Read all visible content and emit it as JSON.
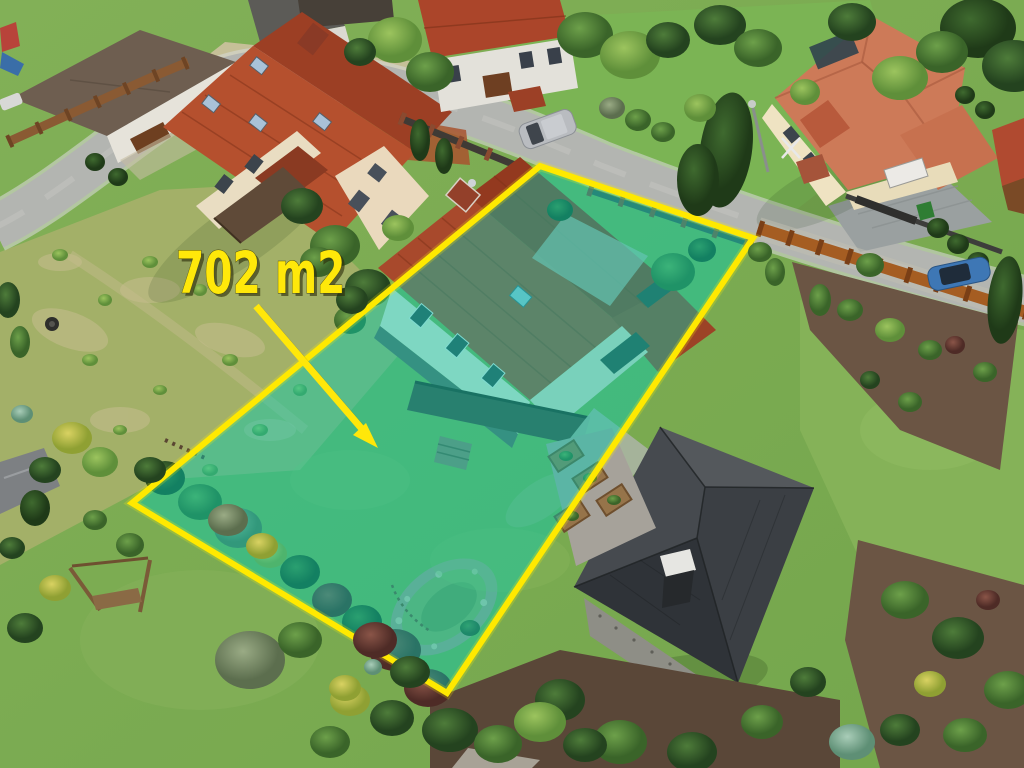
{
  "annotation": {
    "area_label": "702 m2",
    "label_color": "#ffe80a",
    "outline_color": "#ffe701",
    "fill_color": "#00cdb4",
    "arrow_color": "#ffe70a"
  }
}
